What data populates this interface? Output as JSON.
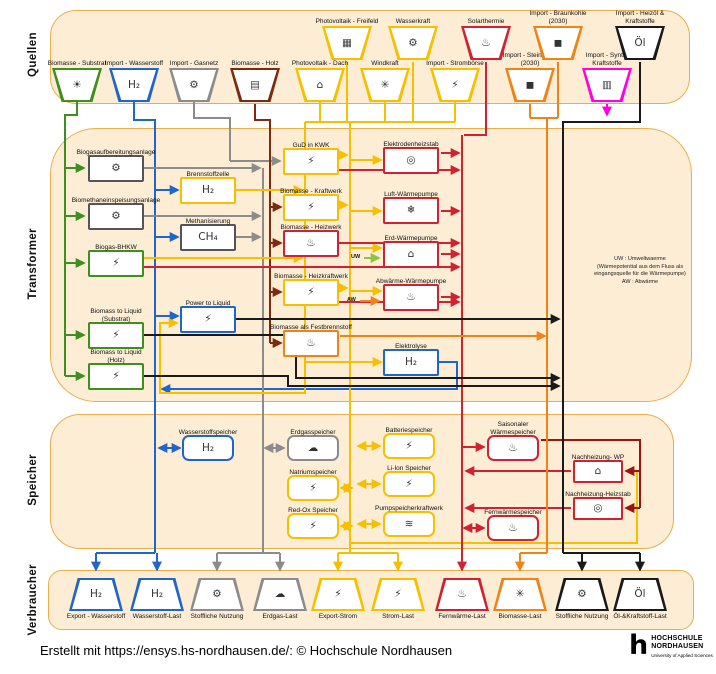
{
  "sections": {
    "quellen": {
      "label": "Quellen"
    },
    "transformer": {
      "label": "Transformer"
    },
    "speicher": {
      "label": "Speicher"
    },
    "verbraucher": {
      "label": "Verbraucher"
    }
  },
  "note": {
    "line1": "UW : Umweltwaerme",
    "line2": "(Wärmepotential aus dem Fluss als",
    "line3": "eingangsquelle für die Wärmepumpe)",
    "line4": "AW : Abwärme"
  },
  "flow_labels": {
    "uw": "UW",
    "aw": "AW"
  },
  "footer": {
    "credit": "Erstellt mit https://ensys.hs-nordhausen.de/: © Hochschule Nordhausen",
    "logo_glyph": "h",
    "logo_line1": "HOCHSCHULE",
    "logo_line2": "NORDHAUSEN",
    "logo_sub": "University of Applied Sciences"
  },
  "colors": {
    "green": "#3e8e20",
    "lightgreen": "#8cc63f",
    "blue": "#2065c9",
    "gray": "#8c8c8c",
    "neutral": "#555555",
    "brown": "#7d2a10",
    "yellow": "#f6bf00",
    "red": "#cf2333",
    "darkred": "#9b1313",
    "orange": "#ef8318",
    "magenta": "#ff00e1",
    "black": "#1a1a1a",
    "band_fill": "#fcedd4",
    "band_border": "#e9ae4b"
  },
  "icon_glyphs": {
    "energy-crops": "☀",
    "h2-molecules": "H₂",
    "gas-valve": "⚙",
    "wood-logs": "▤",
    "solar-roof": "⌂",
    "wind-turbine": "✳",
    "power-pylon": "⚡",
    "coal-cart": "◼",
    "fuel-pump": "▥",
    "solar-field": "▦",
    "water-wheel": "⚙",
    "solar-thermal": "♨",
    "oil-barrel": "Öl",
    "biogas-plant": "⚙",
    "gas-injection": "⚙",
    "chp-engine": "⚡",
    "fuel-drop": "⚡",
    "fuel-cell": "H₂",
    "ch4-cloud": "CH₄",
    "power-plant": "⚡",
    "boiler": "♨",
    "flame": "♨",
    "heating-coil": "◎",
    "heat-pump-air": "❄",
    "heat-pump-ground": "⌂",
    "heat-pump-waste": "♨",
    "electrolysis": "H₂",
    "h2-tank": "H₂",
    "gas-tank": "☁",
    "battery": "⚡",
    "dam": "≋",
    "heat-store": "♨",
    "truck": "H₂",
    "gas-bottles": "H₂",
    "material-use": "⚙",
    "gas-bottle": "☁",
    "bulb": "⚡",
    "bolt": "⚡",
    "radiator": "♨",
    "pellet-bag": "✳",
    "gears": "⚙",
    "fuel-nozzle": "Öl"
  },
  "nodes": {
    "sources": [
      {
        "id": "biomasse-substrat",
        "label": "Biomasse - Substrat",
        "color": "green",
        "icon": "energy-crops",
        "cx": 77,
        "row": "lower"
      },
      {
        "id": "import-wasserstoff",
        "label": "Import - Wasserstoff",
        "color": "blue",
        "icon": "h2-molecules",
        "cx": 134,
        "row": "lower"
      },
      {
        "id": "import-gasnetz",
        "label": "Import - Gasnetz",
        "color": "gray",
        "icon": "gas-valve",
        "cx": 194,
        "row": "lower"
      },
      {
        "id": "biomasse-holz",
        "label": "Biomasse - Holz",
        "color": "brown",
        "icon": "wood-logs",
        "cx": 255,
        "row": "lower"
      },
      {
        "id": "photovoltaik-dach",
        "label": "Photovoltaik - Dach",
        "color": "yellow",
        "icon": "solar-roof",
        "cx": 320,
        "row": "lower"
      },
      {
        "id": "windkraft",
        "label": "Windkraft",
        "color": "yellow",
        "icon": "wind-turbine",
        "cx": 385,
        "row": "lower"
      },
      {
        "id": "import-stromboerse",
        "label": "Import - Strombörse",
        "color": "yellow",
        "icon": "power-pylon",
        "cx": 455,
        "row": "lower"
      },
      {
        "id": "import-steinkohle-2030",
        "label": "Import - Steinkohle",
        "label2": "(2030)",
        "color": "orange",
        "icon": "coal-cart",
        "cx": 530,
        "row": "lower"
      },
      {
        "id": "import-synth-kraftstoffe",
        "label": "Import - Synth.",
        "label2": "Kraftstoffe",
        "color": "magenta",
        "icon": "fuel-pump",
        "cx": 607,
        "row": "lower"
      },
      {
        "id": "photovoltaik-freifeld",
        "label": "Photovoltaik - Freifeld",
        "color": "yellow",
        "icon": "solar-field",
        "cx": 347,
        "row": "upper"
      },
      {
        "id": "wasserkraft",
        "label": "Wasserkraft",
        "color": "yellow",
        "icon": "water-wheel",
        "cx": 413,
        "row": "upper"
      },
      {
        "id": "solarthermie",
        "label": "Solarthermie",
        "color": "red",
        "icon": "solar-thermal",
        "cx": 486,
        "row": "upper"
      },
      {
        "id": "import-braunkohle-2030",
        "label": "Import - Braunkohle",
        "label2": "(2030)",
        "color": "orange",
        "icon": "coal-cart",
        "cx": 558,
        "row": "upper"
      },
      {
        "id": "import-heizoel-kraftstoffe",
        "label": "Import - Heizöl &",
        "label2": "Kraftstoffe",
        "color": "black",
        "icon": "oil-barrel",
        "cx": 640,
        "row": "upper"
      }
    ],
    "transformers": [
      {
        "id": "biogasaufbereitungsanlage",
        "label": "Biogasaufbereitungsanlage",
        "color": "neutral",
        "icon": "biogas-plant",
        "x": 88,
        "y": 155
      },
      {
        "id": "biomethaneinspeisungsanlage",
        "label": "Biomethaneinspeisungsanlage",
        "color": "neutral",
        "icon": "gas-injection",
        "x": 88,
        "y": 203
      },
      {
        "id": "biogas-bhkw",
        "label": "Biogas-BHKW",
        "color": "green",
        "icon": "chp-engine",
        "x": 88,
        "y": 250
      },
      {
        "id": "biomass-to-liquid-substrat",
        "label": "Biomass to Liquid",
        "label2": "(Substrat)",
        "color": "green",
        "icon": "fuel-drop",
        "x": 88,
        "y": 322
      },
      {
        "id": "biomass-to-liquid-holz",
        "label": "Biomass to Liquid",
        "label2": "(Holz)",
        "color": "green",
        "icon": "fuel-drop",
        "x": 88,
        "y": 363
      },
      {
        "id": "brennstoffzelle",
        "label": "Brennstoffzelle",
        "color": "yellow",
        "icon": "fuel-cell",
        "x": 180,
        "y": 177
      },
      {
        "id": "methanisierung",
        "label": "Methanisierung",
        "color": "neutral",
        "icon": "ch4-cloud",
        "x": 180,
        "y": 224
      },
      {
        "id": "power-to-liquid",
        "label": "Power to Liquid",
        "color": "blue",
        "icon": "fuel-drop",
        "x": 180,
        "y": 306
      },
      {
        "id": "gud-in-kwk",
        "label": "GuD in KWK",
        "color": "yellow",
        "icon": "power-plant",
        "x": 283,
        "y": 148
      },
      {
        "id": "biomasse-kraftwerk",
        "label": "Biomasse - Kraftwerk",
        "color": "yellow",
        "icon": "power-plant",
        "x": 283,
        "y": 194
      },
      {
        "id": "biomasse-heizwerk",
        "label": "Biomasse - Heizwerk",
        "color": "red",
        "icon": "boiler",
        "x": 283,
        "y": 230
      },
      {
        "id": "biomasse-heizkraftwerk",
        "label": "Biomasse - Heizkraftwerk",
        "color": "yellow",
        "icon": "power-plant",
        "x": 283,
        "y": 279
      },
      {
        "id": "biomasse-als-festbrennstoff",
        "label": "Biomasse als Festbrennstoff",
        "color": "orange",
        "icon": "flame",
        "x": 283,
        "y": 330
      },
      {
        "id": "elektrodenheizstab",
        "label": "Elektrodenheizstab",
        "color": "red",
        "icon": "heating-coil",
        "x": 383,
        "y": 147
      },
      {
        "id": "luft-waermepumpe",
        "label": "Luft-Wärmepumpe",
        "color": "red",
        "icon": "heat-pump-air",
        "x": 383,
        "y": 197
      },
      {
        "id": "erd-waermepumpe",
        "label": "Erd-Wärmepumpe",
        "color": "red",
        "icon": "heat-pump-ground",
        "x": 383,
        "y": 241
      },
      {
        "id": "abwaerme-waermepumpe",
        "label": "Abwärme-Wärmepumpe",
        "color": "red",
        "icon": "heat-pump-waste",
        "x": 383,
        "y": 284
      },
      {
        "id": "elektrolyse",
        "label": "Elektrolyse",
        "color": "blue",
        "icon": "electrolysis",
        "x": 383,
        "y": 349
      }
    ],
    "stores": [
      {
        "id": "wasserstoffspeicher",
        "label": "Wasserstoffspeicher",
        "color": "blue",
        "icon": "h2-tank",
        "x": 182,
        "y": 435
      },
      {
        "id": "erdgasspeicher",
        "label": "Erdgasspeicher",
        "color": "gray",
        "icon": "gas-tank",
        "x": 287,
        "y": 435
      },
      {
        "id": "natriumspeicher",
        "label": "Natriumspeicher",
        "color": "yellow",
        "icon": "battery",
        "x": 287,
        "y": 475
      },
      {
        "id": "red-ox-speicher",
        "label": "Red-Ox Speicher",
        "color": "yellow",
        "icon": "battery",
        "x": 287,
        "y": 513
      },
      {
        "id": "batteriespeicher",
        "label": "Batteriespeicher",
        "color": "yellow",
        "icon": "battery",
        "x": 383,
        "y": 433
      },
      {
        "id": "li-ion-speicher",
        "label": "Li-Ion Speicher",
        "color": "yellow",
        "icon": "battery",
        "x": 383,
        "y": 471
      },
      {
        "id": "pumpspeicherkraftwerk",
        "label": "Pumpspeicherkraftwerk",
        "color": "yellow",
        "icon": "dam",
        "x": 383,
        "y": 511
      },
      {
        "id": "saisonaler-waermespeicher",
        "label": "Saisonaler",
        "label2": "Wärmespeicher",
        "color": "red",
        "icon": "heat-store",
        "x": 487,
        "y": 435
      },
      {
        "id": "nachheizung-wp",
        "label": "Nachheizung- WP",
        "color": "red",
        "icon": "heat-pump-ground",
        "x": 573,
        "y": 460,
        "w": 50,
        "h": 23,
        "sq": true
      },
      {
        "id": "nachheizung-heizstab",
        "label": "Nachheizung-Heizstab",
        "color": "red",
        "icon": "heating-coil",
        "x": 573,
        "y": 497,
        "w": 50,
        "h": 23,
        "sq": true
      },
      {
        "id": "fernwaermespeicher",
        "label": "Fernwärmespeicher",
        "color": "red",
        "icon": "heat-store",
        "x": 487,
        "y": 515
      }
    ],
    "loads": [
      {
        "id": "export-wasserstoff",
        "label": "Export - Wasserstoff",
        "color": "blue",
        "icon": "truck",
        "cx": 96
      },
      {
        "id": "wasserstoff-last",
        "label": "Wasserstoff-Last",
        "color": "blue",
        "icon": "gas-bottles",
        "cx": 157
      },
      {
        "id": "stoffliche-nutzung-gas",
        "label": "Stoffliche Nutzung",
        "color": "gray",
        "icon": "material-use",
        "cx": 217
      },
      {
        "id": "erdgas-last",
        "label": "Erdgas-Last",
        "color": "gray",
        "icon": "gas-bottle",
        "cx": 280
      },
      {
        "id": "export-strom",
        "label": "Export-Strom",
        "color": "yellow",
        "icon": "bulb",
        "cx": 338
      },
      {
        "id": "strom-last",
        "label": "Strom-Last",
        "color": "yellow",
        "icon": "bolt",
        "cx": 398
      },
      {
        "id": "fernwaerme-last",
        "label": "Fernwärme-Last",
        "color": "red",
        "icon": "radiator",
        "cx": 462
      },
      {
        "id": "biomasse-last",
        "label": "Biomasse-Last",
        "color": "orange",
        "icon": "pellet-bag",
        "cx": 520
      },
      {
        "id": "stoffliche-nutzung-oel",
        "label": "Stoffliche Nutzung",
        "color": "black",
        "icon": "gears",
        "cx": 582
      },
      {
        "id": "oel-kraftstoff-last",
        "label": "Öl-&Kraftstoff-Last",
        "color": "black",
        "icon": "fuel-nozzle",
        "cx": 640
      }
    ]
  }
}
